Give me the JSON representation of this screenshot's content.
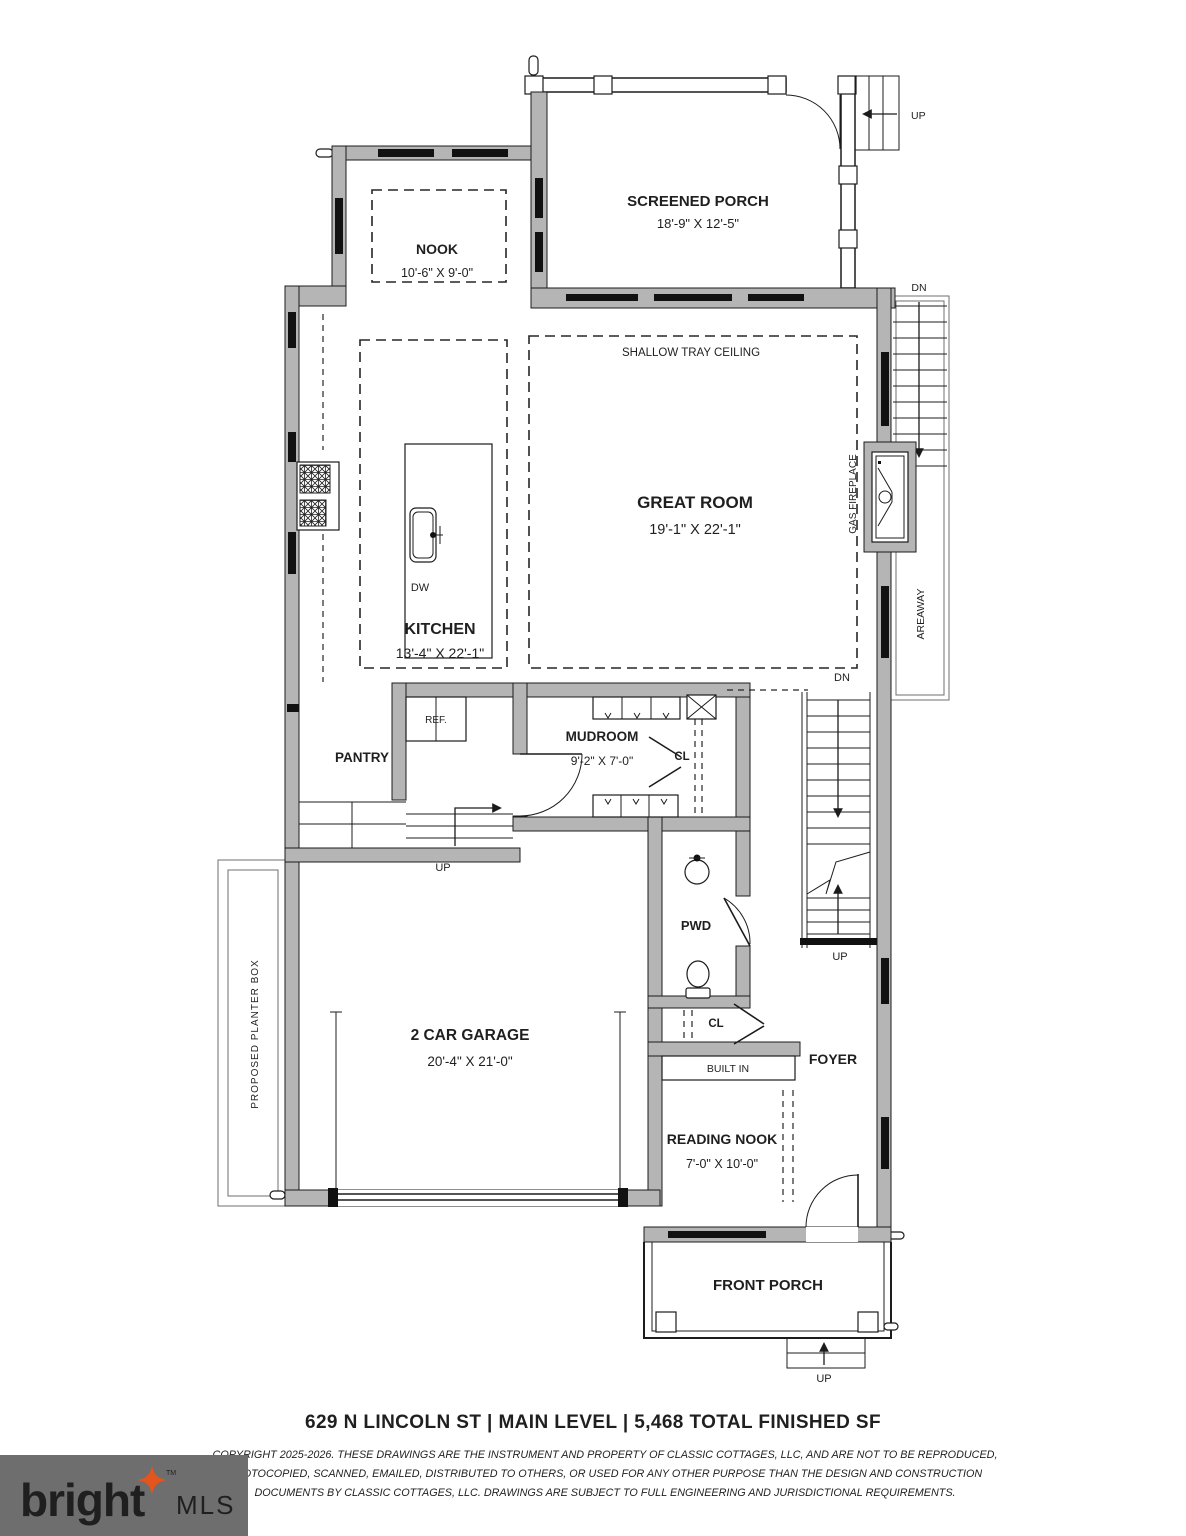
{
  "plan": {
    "rooms": {
      "screened_porch": {
        "name": "SCREENED PORCH",
        "dims": "18'-9\" X 12'-5\""
      },
      "nook": {
        "name": "NOOK",
        "dims": "10'-6\" X 9'-0\""
      },
      "great_room": {
        "name": "GREAT ROOM",
        "dims": "19'-1\" X 22'-1\"",
        "ceiling_note": "SHALLOW TRAY CEILING"
      },
      "kitchen": {
        "name": "KITCHEN",
        "dims": "13'-4\" X 22'-1\""
      },
      "mudroom": {
        "name": "MUDROOM",
        "dims": "9'-2\" X 7'-0\""
      },
      "pantry": {
        "name": "PANTRY"
      },
      "powder_room": {
        "name": "PWD"
      },
      "foyer": {
        "name": "FOYER"
      },
      "reading_nook": {
        "name": "READING NOOK",
        "dims": "7'-0\" X 10'-0\""
      },
      "garage": {
        "name": "2 CAR GARAGE",
        "dims": "20'-4\" X 21'-0\""
      },
      "front_porch": {
        "name": "FRONT PORCH"
      }
    },
    "fixtures": {
      "refrigerator": "REF.",
      "dishwasher": "DW",
      "closet": "CL",
      "built_in": "BUILT IN",
      "gas_fireplace": "GAS FIREPLACE",
      "areaway": "AREAWAY",
      "planter_box": "PROPOSED PLANTER BOX"
    },
    "directions": {
      "up": "UP",
      "down": "DN"
    }
  },
  "footer": {
    "title": "629 N LINCOLN ST | MAIN LEVEL | 5,468 TOTAL FINISHED SF",
    "copyright": {
      "line1": "COPYRIGHT 2025-2026.  THESE DRAWINGS ARE THE INSTRUMENT AND PROPERTY OF CLASSIC COTTAGES, LLC, AND ARE NOT TO BE REPRODUCED,",
      "line2": "PHOTOCOPIED, SCANNED, EMAILED, DISTRIBUTED TO OTHERS, OR USED FOR ANY OTHER PURPOSE THAN THE DESIGN AND CONSTRUCTION",
      "line3": "DOCUMENTS BY CLASSIC COTTAGES, LLC.  DRAWINGS ARE SUBJECT TO FULL ENGINEERING AND JURISDICTIONAL REQUIREMENTS."
    }
  },
  "logo": {
    "brand": "bright",
    "suffix": "MLS",
    "tm": "TM"
  },
  "colors": {
    "wall_fill": "#b5b5b5",
    "line": "#1c1c1c",
    "window": "#111111",
    "logo_bg": "#6e6e6e",
    "logo_star": "#e2551c"
  }
}
